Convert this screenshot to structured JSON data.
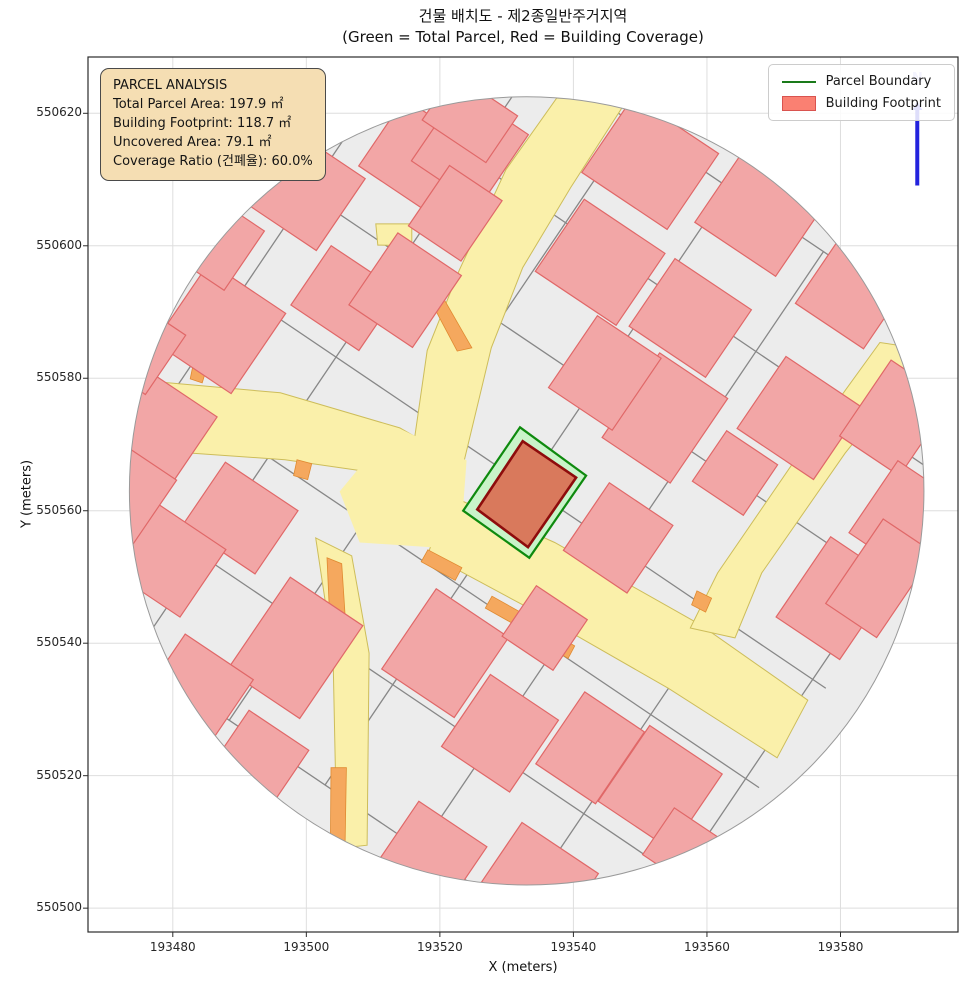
{
  "chart_data": {
    "type": "map",
    "title": "건물 배치도 - 제2종일반주거지역",
    "subtitle": "(Green = Total Parcel, Red = Building Coverage)",
    "xlabel": "X (meters)",
    "ylabel": "Y (meters)",
    "x_ticks": [
      193480,
      193500,
      193520,
      193540,
      193560,
      193580
    ],
    "y_ticks": [
      550500,
      550520,
      550540,
      550560,
      550580,
      550600,
      550620
    ],
    "xlim": [
      193467.3,
      193597.6
    ],
    "ylim": [
      550496.4,
      550628.5
    ],
    "grid": true,
    "legend_position": "upper right",
    "analysis": {
      "total_parcel_area_m2": 197.9,
      "building_footprint_m2": 118.7,
      "uncovered_area_m2": 79.1,
      "coverage_ratio_pct": 60.0,
      "zoning": "제2종일반주거지역"
    },
    "map": {
      "boundary_circle": {
        "x": 193533.0,
        "y": 550563.0,
        "r": 59.5
      },
      "grid_angle_deg": 34,
      "street_lines": [
        [
          [
            193459.8,
            550547.7
          ],
          [
            193520.3,
            550638.0
          ]
        ],
        [
          [
            193474.2,
            550538.1
          ],
          [
            193534.7,
            550628.3
          ]
        ],
        [
          [
            193488.4,
            550528.3
          ],
          [
            193548.9,
            550618.5
          ]
        ],
        [
          [
            193502.8,
            550518.6
          ],
          [
            193563.3,
            550608.9
          ]
        ],
        [
          [
            193517.0,
            550509.0
          ],
          [
            193577.5,
            550599.2
          ]
        ],
        [
          [
            193531.4,
            550499.1
          ],
          [
            193591.9,
            550589.4
          ]
        ],
        [
          [
            193545.6,
            550489.4
          ],
          [
            193606.1,
            550579.7
          ]
        ],
        [
          [
            193458.0,
            550549.1
          ],
          [
            193547.6,
            550488.1
          ]
        ],
        [
          [
            193468.2,
            550564.2
          ],
          [
            193557.8,
            550503.2
          ]
        ],
        [
          [
            193478.2,
            550579.1
          ],
          [
            193567.8,
            550518.2
          ]
        ],
        [
          [
            193488.3,
            550594.2
          ],
          [
            193577.8,
            550533.2
          ]
        ],
        [
          [
            193498.3,
            550609.3
          ],
          [
            193587.9,
            550548.4
          ]
        ],
        [
          [
            193508.3,
            550624.3
          ],
          [
            193597.9,
            550563.2
          ]
        ],
        [
          [
            193518.4,
            550639.3
          ],
          [
            193607.9,
            550578.4
          ]
        ]
      ],
      "roads": [
        [
          [
            193537.5,
            550622.3
          ],
          [
            193529.9,
            550611.5
          ],
          [
            193522.9,
            550596.3
          ],
          [
            193518.1,
            550584.2
          ],
          [
            193516.0,
            550569.5
          ],
          [
            193523.3,
            550566.1
          ],
          [
            193527.7,
            550584.6
          ],
          [
            193532.4,
            550596.7
          ],
          [
            193539.6,
            550608.8
          ],
          [
            193548.2,
            550622.3
          ]
        ],
        [
          [
            193471.8,
            550580.0
          ],
          [
            193496.1,
            550577.8
          ],
          [
            193514.0,
            550572.5
          ],
          [
            193519.7,
            550569.2
          ],
          [
            193520.8,
            550561.2
          ],
          [
            193513.3,
            550565.3
          ],
          [
            193496.8,
            550567.7
          ],
          [
            193471.3,
            550569.5
          ]
        ],
        [
          [
            193521.5,
            550562.3
          ],
          [
            193537.2,
            550555.2
          ],
          [
            193559.0,
            550542.8
          ],
          [
            193575.1,
            550531.4
          ],
          [
            193570.5,
            550522.7
          ],
          [
            193554.2,
            550533.2
          ],
          [
            193532.4,
            550545.8
          ],
          [
            193518.2,
            550553.5
          ]
        ],
        [
          [
            193501.4,
            550555.9
          ],
          [
            193506.8,
            550553.2
          ],
          [
            193509.4,
            550538.5
          ],
          [
            193509.1,
            550509.5
          ],
          [
            193504.6,
            550509.0
          ],
          [
            193504.0,
            550538.5
          ]
        ],
        [
          [
            193585.9,
            550585.4
          ],
          [
            193573.9,
            550568.7
          ],
          [
            193561.6,
            550550.6
          ],
          [
            193557.5,
            550542.3
          ],
          [
            193564.2,
            550540.8
          ],
          [
            193568.2,
            550550.6
          ],
          [
            193580.7,
            550568.7
          ],
          [
            193593.1,
            550584.3
          ]
        ],
        [
          [
            193510.4,
            550603.3
          ],
          [
            193515.8,
            550603.3
          ],
          [
            193515.8,
            550600.0
          ],
          [
            193510.7,
            550600.1
          ]
        ]
      ],
      "junction": [
        [
          193514.0,
          550572.4
        ],
        [
          193524.0,
          550567.6
        ],
        [
          193523.0,
          550554.2
        ],
        [
          193508.0,
          550555.2
        ],
        [
          193505.0,
          550562.9
        ],
        [
          193512.0,
          550571.5
        ]
      ],
      "orange_zones": [
        [
          [
            193513.6,
            550601.2
          ],
          [
            193515.8,
            550600.4
          ],
          [
            193524.8,
            550584.6
          ],
          [
            193522.6,
            550584.1
          ]
        ],
        [
          [
            193518.2,
            550554.1
          ],
          [
            193523.3,
            550551.4
          ],
          [
            193522.3,
            550549.5
          ],
          [
            193517.2,
            550552.3
          ]
        ],
        [
          [
            193527.8,
            550547.1
          ],
          [
            193532.4,
            550544.5
          ],
          [
            193531.4,
            550542.7
          ],
          [
            193526.8,
            550545.3
          ]
        ],
        [
          [
            193503.1,
            550552.9
          ],
          [
            193505.3,
            550552.0
          ],
          [
            193506.1,
            550539.6
          ],
          [
            193503.7,
            550539.6
          ]
        ],
        [
          [
            193503.7,
            550521.2
          ],
          [
            193506.0,
            550521.2
          ],
          [
            193505.8,
            550509.9
          ],
          [
            193503.6,
            550509.5
          ]
        ],
        [
          [
            193483.0,
            550581.8
          ],
          [
            193485.0,
            550581.3
          ],
          [
            193484.4,
            550579.3
          ],
          [
            193482.6,
            550579.9
          ]
        ],
        [
          [
            193498.6,
            550567.7
          ],
          [
            193500.8,
            550567.1
          ],
          [
            193500.2,
            550564.7
          ],
          [
            193498.1,
            550565.3
          ]
        ],
        [
          [
            193558.5,
            550547.9
          ],
          [
            193560.7,
            550546.8
          ],
          [
            193559.8,
            550544.7
          ],
          [
            193557.7,
            550545.8
          ]
        ],
        [
          [
            193533.5,
            550543.5
          ],
          [
            193540.2,
            550539.6
          ],
          [
            193539.2,
            550537.7
          ],
          [
            193532.4,
            550541.7
          ]
        ]
      ],
      "buildings_xywh": [
        [
          193499.1,
          550608.8,
          14.6,
          13.1
        ],
        [
          193517.0,
          550613.3,
          13.8,
          12.3
        ],
        [
          193524.5,
          550614.8,
          12.3,
          13.1
        ],
        [
          193522.3,
          550604.9,
          9.5,
          11.0
        ],
        [
          193551.5,
          550612.5,
          15.4,
          13.8
        ],
        [
          193567.9,
          550604.9,
          14.6,
          13.1
        ],
        [
          193582.2,
          550593.6,
          12.3,
          13.8
        ],
        [
          193487.1,
          550587.6,
          13.8,
          14.6
        ],
        [
          193505.8,
          550592.1,
          12.3,
          10.8
        ],
        [
          193544.0,
          550597.5,
          14.6,
          13.1
        ],
        [
          193557.5,
          550589.1,
          13.8,
          12.3
        ],
        [
          193573.9,
          550574.0,
          13.8,
          13.1
        ],
        [
          193588.2,
          550574.0,
          10.8,
          13.8
        ],
        [
          193478.1,
          550572.5,
          12.3,
          12.3
        ],
        [
          193490.1,
          550558.9,
          13.1,
          11.5
        ],
        [
          193553.7,
          550574.0,
          12.3,
          15.4
        ],
        [
          193589.7,
          550558.9,
          11.5,
          13.1
        ],
        [
          193478.8,
          550552.9,
          13.8,
          12.3
        ],
        [
          193498.3,
          550539.3,
          13.1,
          16.9
        ],
        [
          193520.8,
          550538.5,
          13.1,
          14.6
        ],
        [
          193529.0,
          550526.4,
          12.3,
          13.1
        ],
        [
          193518.5,
          550507.6,
          12.3,
          12.3
        ],
        [
          193553.0,
          550518.2,
          13.1,
          13.8
        ],
        [
          193579.2,
          550546.8,
          11.5,
          14.6
        ],
        [
          193542.5,
          550524.2,
          10.8,
          13.1
        ],
        [
          193489.3,
          550504.6,
          13.1,
          9.2
        ],
        [
          193535.0,
          550504.6,
          13.8,
          10.8
        ],
        [
          193557.5,
          550508.4,
          11.5,
          8.5
        ],
        [
          193475.1,
          550584.6,
          9.2,
          10.8
        ],
        [
          193473.6,
          550561.9,
          8.5,
          12.3
        ],
        [
          193485.6,
          550601.2,
          12.3,
          10.8
        ],
        [
          193514.8,
          550593.3,
          11.5,
          13.1
        ],
        [
          193544.7,
          550580.8,
          11.5,
          13.1
        ],
        [
          193585.9,
          550549.8,
          9.2,
          15.4
        ],
        [
          193524.5,
          550619.3,
          11.5,
          8.5
        ],
        [
          193483.3,
          550532.5,
          12.3,
          13.1
        ],
        [
          193493.1,
          550522.7,
          10.8,
          10.0
        ],
        [
          193535.7,
          550542.3,
          9.2,
          9.2
        ],
        [
          193546.7,
          550555.9,
          11.5,
          12.3
        ],
        [
          193564.2,
          550565.7,
          9.2,
          9.2
        ]
      ],
      "highlight_parcel": [
        [
          193532.0,
          550572.6
        ],
        [
          193541.9,
          550565.3
        ],
        [
          193533.4,
          550552.9
        ],
        [
          193523.5,
          550560.0
        ]
      ],
      "highlight_building": [
        [
          193532.4,
          550570.5
        ],
        [
          193540.4,
          550565.0
        ],
        [
          193533.2,
          550554.5
        ],
        [
          193525.6,
          550560.2
        ]
      ],
      "north_arrow": {
        "x": 193591.5,
        "y_bottom": 550609.1,
        "y_top": 550620.5,
        "label_y": 550624.7
      }
    }
  },
  "info_box": {
    "lines": [
      "PARCEL ANALYSIS",
      "Total Parcel Area: 197.9 ㎡",
      "Building Footprint: 118.7 ㎡",
      "Uncovered Area: 79.1 ㎡",
      "Coverage Ratio (건폐율): 60.0%"
    ]
  },
  "legend": {
    "items": [
      {
        "label": "Parcel Boundary",
        "swatch": "line"
      },
      {
        "label": "Building Footprint",
        "swatch": "patch"
      }
    ]
  },
  "north_label": "N",
  "colors": {
    "grid": "#dedede",
    "frame": "#2b2b2b",
    "circle_fill": "#ececec",
    "circle_stroke": "#9a9a9a",
    "street_line": "#878787",
    "road_fill": "#faf0aa",
    "road_stroke": "#cdbd5a",
    "orange_fill": "#f5a85e",
    "orange_stroke": "#e08a30",
    "building_fill": "#f2a6a6",
    "building_stroke": "#e06868",
    "parcel_hl_fill": "#c9f4c9",
    "parcel_hl_stroke": "#0e8a0e",
    "building_hl_fill": "#d9795c",
    "building_hl_stroke": "#8e0c0c",
    "north": "#2323dd",
    "tick": "#262626"
  }
}
